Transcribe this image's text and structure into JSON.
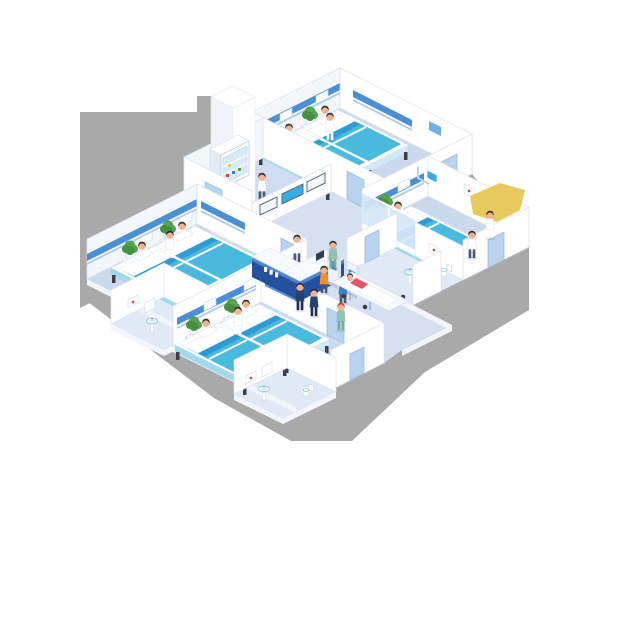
{
  "scene": {
    "title": "Isometric hospital ward floor illustration",
    "desk_sign_marks": 3
  },
  "rooms": [
    {
      "name": "ward-room-top",
      "beds": 2,
      "patients": 2,
      "staff": [
        "nurse"
      ]
    },
    {
      "name": "ward-room-right",
      "beds": 1,
      "patients": 1,
      "staff": [
        "doctor",
        "nurse"
      ]
    },
    {
      "name": "ward-room-left",
      "beds": 2,
      "patients": 2,
      "staff": [
        "nurse"
      ]
    },
    {
      "name": "ward-room-bottom",
      "beds": 2,
      "patients": 2,
      "staff": [
        "nurse"
      ]
    },
    {
      "name": "supply-room",
      "staff": [
        "pharmacist"
      ],
      "equipment": [
        "medicine-cabinet"
      ]
    },
    {
      "name": "bathroom-right",
      "equipment": [
        "sink",
        "toilet",
        "wall-picture"
      ]
    },
    {
      "name": "bathroom-left",
      "equipment": [
        "sink",
        "mirror",
        "toilet",
        "wall-picture"
      ]
    },
    {
      "name": "bathroom-bottom",
      "equipment": [
        "sink",
        "mirror",
        "toilet",
        "wall-picture"
      ]
    }
  ],
  "corridor": {
    "equipment": [
      "nurse-station-desk",
      "wall-monitors",
      "self-service-kiosk",
      "self-service-kiosk",
      "stretcher",
      "glass-partition"
    ],
    "people": [
      "receptionist",
      "visitor-orange",
      "visitor-blue",
      "security-staff",
      "security-staff",
      "nurse-pushing-stretcher",
      "stretcher-patient",
      "nurse-walking"
    ]
  },
  "highlight": {
    "shape": "yellow-polygon"
  },
  "palette": {
    "shadow": "#a9a9a9",
    "white": "#ffffff",
    "wall_shade": "#f3f6fa",
    "wall_edge": "#d9e2ee",
    "floor": "#cbd9ec",
    "floor_corridor": "#d5e0f1",
    "floor_bath": "#e0e9f5",
    "floor_supply": "#d0dcef",
    "edge_slab": "#f2f5fb",
    "trim": "#4a8fd8",
    "trim_light": "#a9cdf0",
    "panel_blue": "#6db1e8",
    "door": "#b9d3ee",
    "door_frame": "#9dbbdc",
    "mattress": "#2e9ad6",
    "blanket": "#49b9dd",
    "bed_side": "#9fd9ea",
    "bed_foot": "#cfeaf5",
    "metal": "#3e3e46",
    "desk_navy": "#24509c",
    "desk_band": "#4d86d0",
    "desk_top": "#f6f9fd",
    "screen_blue": "#35aee8",
    "kiosk_screen": "#3f8fd9",
    "glass": "#d6e7f7",
    "plant": "#57a24d",
    "plant_dark": "#46903d",
    "pot": "#eef4fa",
    "skin": "#f2b38c",
    "hair": "#2e2e38",
    "red_hair": "#b5523c",
    "trousers": "#4a5a74",
    "scrubs": "#8fc3b4",
    "scrubs_dark": "#79ab9d",
    "navy_uniform": "#27406e",
    "navy_dark": "#1c2f52",
    "orange_shirt": "#f0922b",
    "blue_shirt": "#3a7fd0",
    "stretcher_shirt": "#e2556a",
    "yellow": "#e8c95e",
    "red_dot": "#d94040",
    "table_top": "#f4f8fc",
    "table_side": "#dfe9f5",
    "table_side2": "#eaf1f9",
    "teal_fixture": "#9fd4e4"
  }
}
